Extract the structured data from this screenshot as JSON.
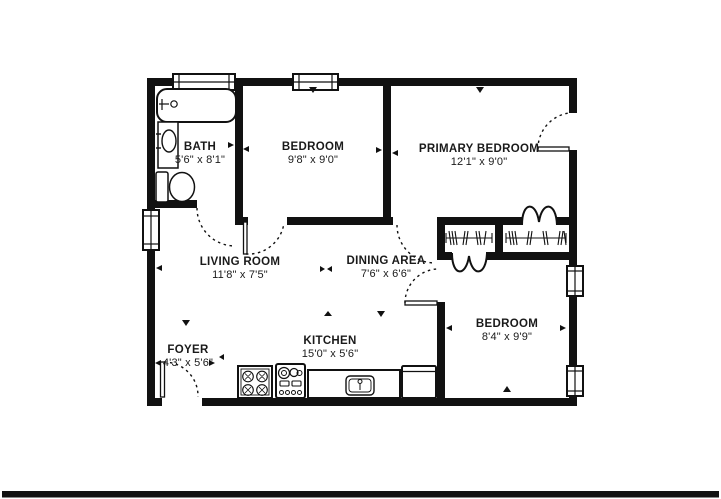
{
  "floor_plan": {
    "rooms": [
      {
        "name": "BATH",
        "dims": "5'6\" x 8'1\""
      },
      {
        "name": "BEDROOM",
        "dims": "9'8\" x 9'0\""
      },
      {
        "name": "PRIMARY BEDROOM",
        "dims": "12'1\" x 9'0\""
      },
      {
        "name": "LIVING ROOM",
        "dims": "11'8\" x 7'5\""
      },
      {
        "name": "DINING AREA",
        "dims": "7'6\" x 6'6\""
      },
      {
        "name": "BEDROOM",
        "dims": "8'4\" x 9'9\""
      },
      {
        "name": "FOYER",
        "dims": "4'3\" x 5'6\""
      },
      {
        "name": "KITCHEN",
        "dims": "15'0\" x 5'6\""
      }
    ],
    "fixtures": [
      "bathtub",
      "vanity-sink",
      "toilet",
      "cooktop",
      "oven-range",
      "kitchen-counter-sink",
      "refrigerator",
      "closet-rod-left",
      "closet-rod-right"
    ],
    "windows_count": 5,
    "doors_count": 8,
    "colors": {
      "wall": "#111111",
      "background": "#ffffff",
      "text": "#1a1a1a",
      "bottom_bar": "#111111"
    }
  }
}
